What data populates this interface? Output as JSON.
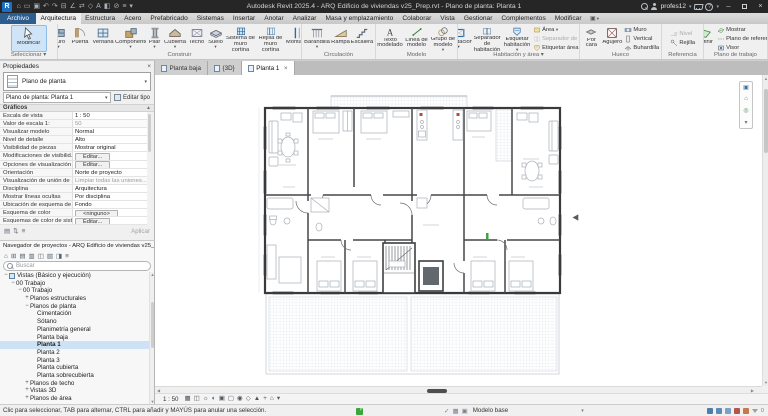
{
  "titlebar": {
    "title": "Autodesk Revit 2025.4 - ARQ Edificio de viviendas v25_Prep.rvt - Plano de planta: Planta 1",
    "user": "profes12",
    "qat": [
      {
        "name": "home",
        "glyph": "⌂"
      },
      {
        "name": "open",
        "glyph": "▭"
      },
      {
        "name": "save",
        "glyph": "▣"
      },
      {
        "name": "undo",
        "glyph": "↶"
      },
      {
        "name": "redo",
        "glyph": "↷"
      },
      {
        "name": "print",
        "glyph": "⊟"
      },
      {
        "name": "measure",
        "glyph": "∠"
      },
      {
        "name": "aligned-dimension",
        "glyph": "⇄"
      },
      {
        "name": "tag",
        "glyph": "◇"
      },
      {
        "name": "text",
        "glyph": "A"
      },
      {
        "name": "default-3d-view",
        "glyph": "◧"
      },
      {
        "name": "section",
        "glyph": "⊘"
      },
      {
        "name": "thin-lines",
        "glyph": "≡"
      },
      {
        "name": "customize-qat",
        "glyph": "▾"
      }
    ]
  },
  "ribbon": {
    "tabs": [
      {
        "label": "Archivo",
        "style": "file"
      },
      {
        "label": "Arquitectura",
        "active": true
      },
      {
        "label": "Estructura"
      },
      {
        "label": "Acero"
      },
      {
        "label": "Prefabricado"
      },
      {
        "label": "Sistemas"
      },
      {
        "label": "Insertar"
      },
      {
        "label": "Anotar"
      },
      {
        "label": "Analizar"
      },
      {
        "label": "Masa y emplazamiento"
      },
      {
        "label": "Colaborar"
      },
      {
        "label": "Vista"
      },
      {
        "label": "Gestionar"
      },
      {
        "label": "Complementos"
      },
      {
        "label": "Modificar"
      }
    ],
    "panels": [
      {
        "label": "Seleccionar",
        "arrow": true,
        "width": 58,
        "items": [
          {
            "type": "big",
            "buttons": [
              {
                "label": "Modificar",
                "icon": "cursor",
                "w": 36,
                "selected": true
              }
            ]
          }
        ]
      },
      {
        "label": "Construir",
        "width": 244,
        "items": [
          {
            "type": "big",
            "buttons": [
              {
                "label": "Muro",
                "icon": "wall",
                "arrow": true,
                "w": 21
              },
              {
                "label": "Puerta",
                "icon": "door",
                "w": 22
              },
              {
                "label": "Ventana",
                "icon": "window",
                "w": 24
              },
              {
                "label": "Componente",
                "icon": "comp",
                "arrow": true,
                "w": 31
              },
              {
                "label": "Pilar",
                "icon": "column",
                "arrow": true,
                "w": 17
              },
              {
                "label": "Cubierta",
                "icon": "roof",
                "arrow": true,
                "w": 24
              },
              {
                "label": "Techo",
                "icon": "ceiling",
                "w": 19
              },
              {
                "label": "Suelo",
                "icon": "floor",
                "arrow": true,
                "w": 19
              },
              {
                "label": "Sistema de muro cortina",
                "icon": "curtain",
                "w": 31,
                "two": true
              },
              {
                "label": "Rejilla de muro cortina",
                "icon": "cgrid",
                "w": 29,
                "two": true
              },
              {
                "label": "Montante",
                "icon": "mullion",
                "w": 26
              }
            ]
          }
        ]
      },
      {
        "label": "Circulación",
        "width": 74,
        "items": [
          {
            "type": "big",
            "buttons": [
              {
                "label": "Barandilla",
                "icon": "railing",
                "arrow": true,
                "w": 27
              },
              {
                "label": "Rampa",
                "icon": "ramp",
                "w": 20
              },
              {
                "label": "Escalera",
                "icon": "stair",
                "w": 23
              }
            ]
          }
        ]
      },
      {
        "label": "Modelo",
        "width": 82,
        "items": [
          {
            "type": "big",
            "buttons": [
              {
                "label": "Texto modelado",
                "icon": "mtext",
                "w": 27,
                "two": true
              },
              {
                "label": "Línea de modelo",
                "icon": "mline",
                "w": 26,
                "two": true
              },
              {
                "label": "Grupo de modelo",
                "icon": "mgroup",
                "arrow": true,
                "w": 27,
                "two": true
              }
            ]
          }
        ]
      },
      {
        "label": "Habitación y área",
        "arrow": true,
        "width": 122,
        "items": [
          {
            "type": "big",
            "buttons": [
              {
                "label": "Habitación",
                "icon": "room",
                "arrow": true,
                "w": 26
              },
              {
                "label": "Separador de habitación",
                "icon": "roomsep",
                "w": 31,
                "two": true
              },
              {
                "label": "Etiquetar habitación",
                "icon": "roomtag",
                "arrow": true,
                "w": 29,
                "two": true
              }
            ]
          },
          {
            "type": "stack",
            "buttons": [
              {
                "label": "Área",
                "icon": "area",
                "arrow": true
              },
              {
                "label": "Separador de área",
                "icon": "areasep",
                "disabled": true
              },
              {
                "label": "Etiquetar área",
                "icon": "areatag",
                "arrow": true
              }
            ]
          }
        ]
      },
      {
        "label": "Hueco",
        "width": 82,
        "items": [
          {
            "type": "big",
            "buttons": [
              {
                "label": "Por cara",
                "icon": "face",
                "w": 21,
                "two": true
              },
              {
                "label": "Agujero",
                "icon": "shaft",
                "w": 21
              }
            ]
          },
          {
            "type": "stack",
            "buttons": [
              {
                "label": "Muro",
                "icon": "holewall"
              },
              {
                "label": "Vertical",
                "icon": "vert"
              },
              {
                "label": "Buhardilla",
                "icon": "dormer"
              }
            ]
          }
        ]
      },
      {
        "label": "Referencia",
        "width": 42,
        "items": [
          {
            "type": "stack",
            "buttons": [
              {
                "label": "Nivel",
                "icon": "level",
                "disabled": true
              },
              {
                "label": "Rejilla",
                "icon": "grid"
              }
            ]
          }
        ]
      },
      {
        "label": "Plano de trabajo",
        "width": 64,
        "items": [
          {
            "type": "big",
            "buttons": [
              {
                "label": "Definir",
                "icon": "wpdef",
                "w": 22
              }
            ]
          },
          {
            "type": "stack",
            "buttons": [
              {
                "label": "Mostrar",
                "icon": "wpshow"
              },
              {
                "label": "Plano de referencia",
                "icon": "refplane"
              },
              {
                "label": "Visor",
                "icon": "viewer"
              }
            ]
          }
        ]
      }
    ]
  },
  "properties": {
    "header": "Propiedades",
    "type_selector": "Plano de planta",
    "instance": "Plano de planta: Planta 1",
    "edit_type": "Editar tipo",
    "section": "Gráficos",
    "apply": "Aplicar",
    "rows": [
      {
        "label": "Escala de vista",
        "value": "1 : 50",
        "kind": "text"
      },
      {
        "label": "Valor de escala 1:",
        "value": "50",
        "kind": "gray"
      },
      {
        "label": "Visualizar modelo",
        "value": "Normal",
        "kind": "text"
      },
      {
        "label": "Nivel de detalle",
        "value": "Alto",
        "kind": "text"
      },
      {
        "label": "Visibilidad de piezas",
        "value": "Mostrar original",
        "kind": "text"
      },
      {
        "label": "Modificaciones de visibilid...",
        "value": "Editar...",
        "kind": "button"
      },
      {
        "label": "Opciones de visualización ...",
        "value": "Editar...",
        "kind": "button"
      },
      {
        "label": "Orientación",
        "value": "Norte de proyecto",
        "kind": "text"
      },
      {
        "label": "Visualización de unión de ...",
        "value": "Limpiar todas las uniones...",
        "kind": "gray"
      },
      {
        "label": "Disciplina",
        "value": "Arquitectura",
        "kind": "text"
      },
      {
        "label": "Mostrar líneas ocultas",
        "value": "Por disciplina",
        "kind": "text"
      },
      {
        "label": "Ubicación de esquema de c...",
        "value": "Fondo",
        "kind": "text"
      },
      {
        "label": "Esquema de color",
        "value": "<ninguno>",
        "kind": "button"
      },
      {
        "label": "Esquemas de color de sist...",
        "value": "Editar...",
        "kind": "button"
      }
    ]
  },
  "browser": {
    "header": "Navegador de proyectos - ARQ Edificio de viviendas v25_Prep.rvt",
    "search_placeholder": "Buscar",
    "tools": [
      "⌂",
      "⊞",
      "▤",
      "▥",
      "◫",
      "▧",
      "◨",
      "≡"
    ],
    "tree": [
      {
        "d": 0,
        "exp": "−",
        "icon": true,
        "label": "Vistas (Básico y ejecución)"
      },
      {
        "d": 1,
        "exp": "−",
        "label": "00 Trabajo"
      },
      {
        "d": 2,
        "exp": "−",
        "label": "00 Trabajo"
      },
      {
        "d": 3,
        "exp": "+",
        "label": "Planos estructurales"
      },
      {
        "d": 3,
        "exp": "−",
        "label": "Planos de planta"
      },
      {
        "d": 4,
        "label": "Cimentación"
      },
      {
        "d": 4,
        "label": "Sótano"
      },
      {
        "d": 4,
        "label": "Planimetría general"
      },
      {
        "d": 4,
        "label": "Planta baja"
      },
      {
        "d": 4,
        "label": "Planta 1",
        "selected": true
      },
      {
        "d": 4,
        "label": "Planta 2"
      },
      {
        "d": 4,
        "label": "Planta 3"
      },
      {
        "d": 4,
        "label": "Planta cubierta"
      },
      {
        "d": 4,
        "label": "Planta sobrecubierta"
      },
      {
        "d": 3,
        "exp": "+",
        "label": "Planos de techo"
      },
      {
        "d": 3,
        "exp": "+",
        "label": "Vistas 3D"
      },
      {
        "d": 3,
        "exp": "+",
        "label": "Planos de área"
      }
    ]
  },
  "view_tabs": [
    {
      "label": "Planta baja"
    },
    {
      "label": "{3D}"
    },
    {
      "label": "Planta 1",
      "active": true,
      "closable": true
    }
  ],
  "view_control": {
    "scale": "1 : 50",
    "icons": [
      {
        "name": "detail-level",
        "glyph": "▦"
      },
      {
        "name": "visual-style",
        "glyph": "◫"
      },
      {
        "name": "sun-path",
        "glyph": "☼"
      },
      {
        "name": "shadows",
        "glyph": "◐"
      },
      {
        "name": "rendering-dialog",
        "glyph": "▣"
      },
      {
        "name": "crop-view",
        "glyph": "▢"
      },
      {
        "name": "crop-region-visibility",
        "glyph": "◉"
      },
      {
        "name": "temporary-hide-isolate",
        "glyph": "◇"
      },
      {
        "name": "reveal-hidden-elements",
        "glyph": "▲"
      },
      {
        "name": "worksharing-display",
        "glyph": "+"
      },
      {
        "name": "temporary-view-properties",
        "glyph": "⌂"
      },
      {
        "name": "more-view-controls",
        "glyph": "▾"
      }
    ]
  },
  "status_bar": {
    "hint": "Clic para seleccionar, TAB para alternar, CTRL para añadir y MAYÚS para anular una selección.",
    "workset": "Modelo base",
    "filter_count": "0",
    "right_icons": [
      {
        "name": "worksharing-status",
        "color": "#4d7dad"
      },
      {
        "name": "editable-only-toggle",
        "color": "#5d8ab5"
      },
      {
        "name": "select-links-toggle",
        "color": "#7aa0c4"
      },
      {
        "name": "select-pinned-toggle",
        "color": "#b5534f"
      },
      {
        "name": "select-underlay-toggle",
        "color": "#c4794d"
      }
    ]
  }
}
